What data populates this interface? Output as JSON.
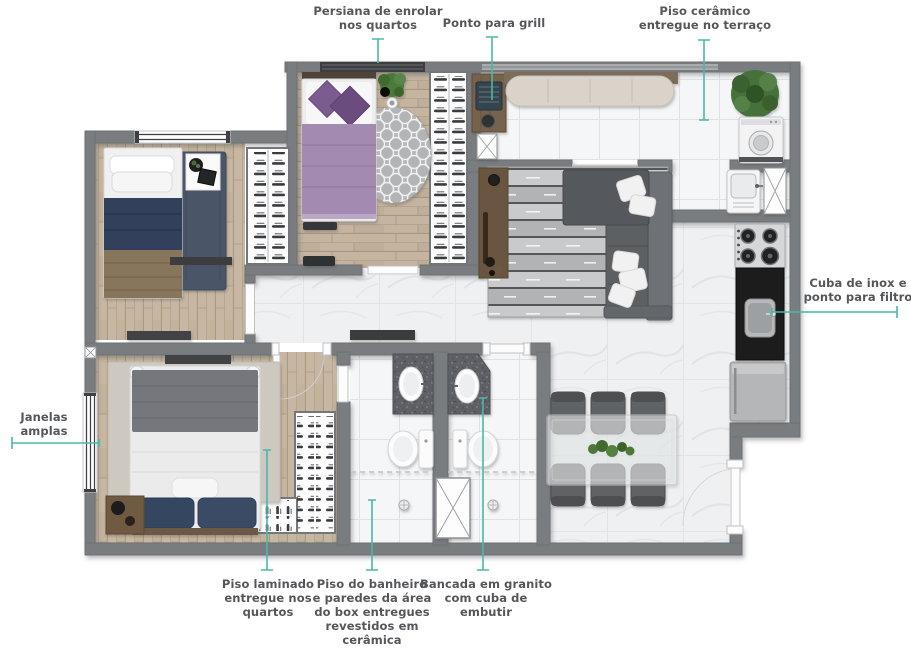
{
  "figure": {
    "kind": "apartment floor plan",
    "accent_color": "#49b8ab",
    "label_color": "#54565a",
    "wall_color": "#7a7d80"
  },
  "callouts": [
    {
      "id": "persiana",
      "lines": [
        "Persiana de enrolar",
        "nos quartos"
      ]
    },
    {
      "id": "ponto-grill",
      "lines": [
        "Ponto para grill"
      ]
    },
    {
      "id": "piso-ceramico",
      "lines": [
        "Piso cerâmico",
        "entregue no terraço"
      ]
    },
    {
      "id": "cuba-inox",
      "lines": [
        "Cuba de inox e",
        "ponto para filtro"
      ]
    },
    {
      "id": "janelas",
      "lines": [
        "Janelas",
        "amplas"
      ]
    },
    {
      "id": "piso-laminado",
      "lines": [
        "Piso laminado",
        "entregue nos",
        "quartos"
      ]
    },
    {
      "id": "piso-banheiro",
      "lines": [
        "Piso do banheiro",
        "e paredes da área",
        "do box entregues",
        "revestidos em",
        "cerâmica"
      ]
    },
    {
      "id": "bancada",
      "lines": [
        "Bancada em granito",
        "com cuba de",
        "embutir"
      ]
    }
  ]
}
